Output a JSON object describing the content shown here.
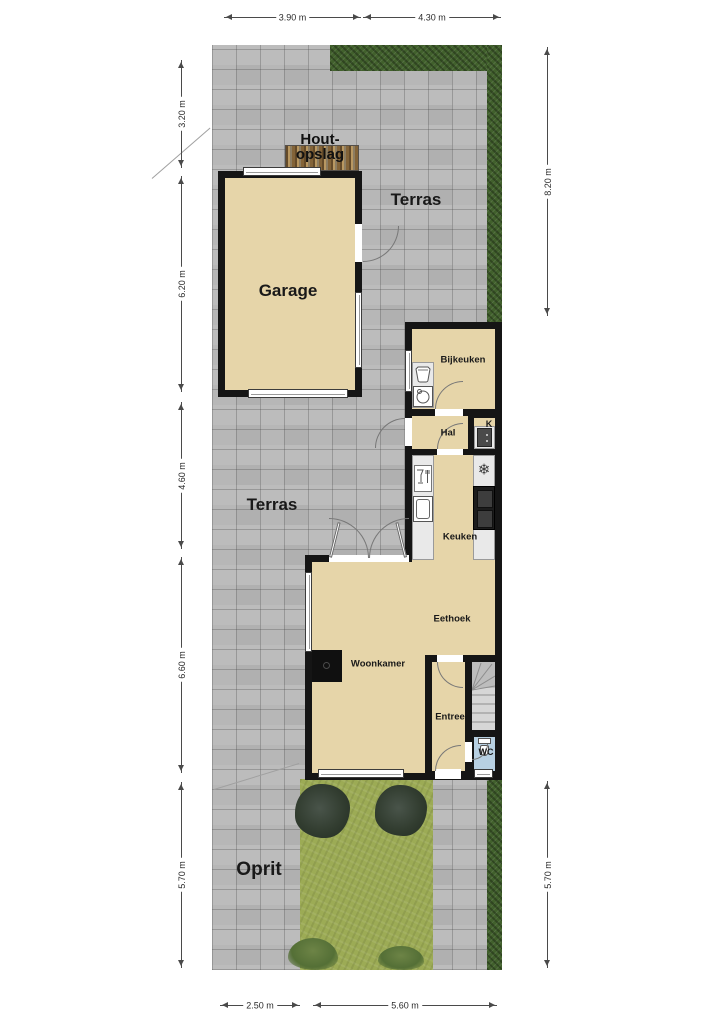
{
  "plan": {
    "labels": {
      "houtopslag_line1": "Hout-",
      "houtopslag_line2": "opslag",
      "terras_top": "Terras",
      "garage": "Garage",
      "bijkeuken": "Bijkeuken",
      "hal": "Hal",
      "kast": "K",
      "keuken": "Keuken",
      "terras_mid": "Terras",
      "eethoek": "Eethoek",
      "woonkamer": "Woonkamer",
      "entree": "Entree",
      "wc": "WC",
      "oprit": "Oprit"
    },
    "dimensions": {
      "top": [
        {
          "label": "3.90 m"
        },
        {
          "label": "4.30 m"
        }
      ],
      "left": [
        {
          "label": "3.20 m"
        },
        {
          "label": "6.20 m"
        },
        {
          "label": "4.60 m"
        },
        {
          "label": "6.60 m"
        },
        {
          "label": "5.70 m"
        }
      ],
      "right": [
        {
          "label": "8.20 m"
        },
        {
          "label": "5.70 m"
        }
      ],
      "bottom": [
        {
          "label": "2.50 m"
        },
        {
          "label": "5.60 m"
        }
      ]
    },
    "icons": {
      "snowflake_glyph": "❄",
      "icon_names": [
        "washbasin-icon",
        "washing-machine-icon",
        "boiler-icon",
        "freezer-icon",
        "dishwasher-icon",
        "sink-icon",
        "cooktop-icon",
        "toilet-icon",
        "stairs"
      ]
    },
    "colors": {
      "paving": "#b5b5b5",
      "hedge": "#41602c",
      "grass": "#9cab55",
      "floor": "#e6d5a9",
      "wall": "#151515",
      "wc_floor": "#b7d0e2",
      "counter": "#e9e9e9",
      "wood": "#a08252"
    }
  }
}
